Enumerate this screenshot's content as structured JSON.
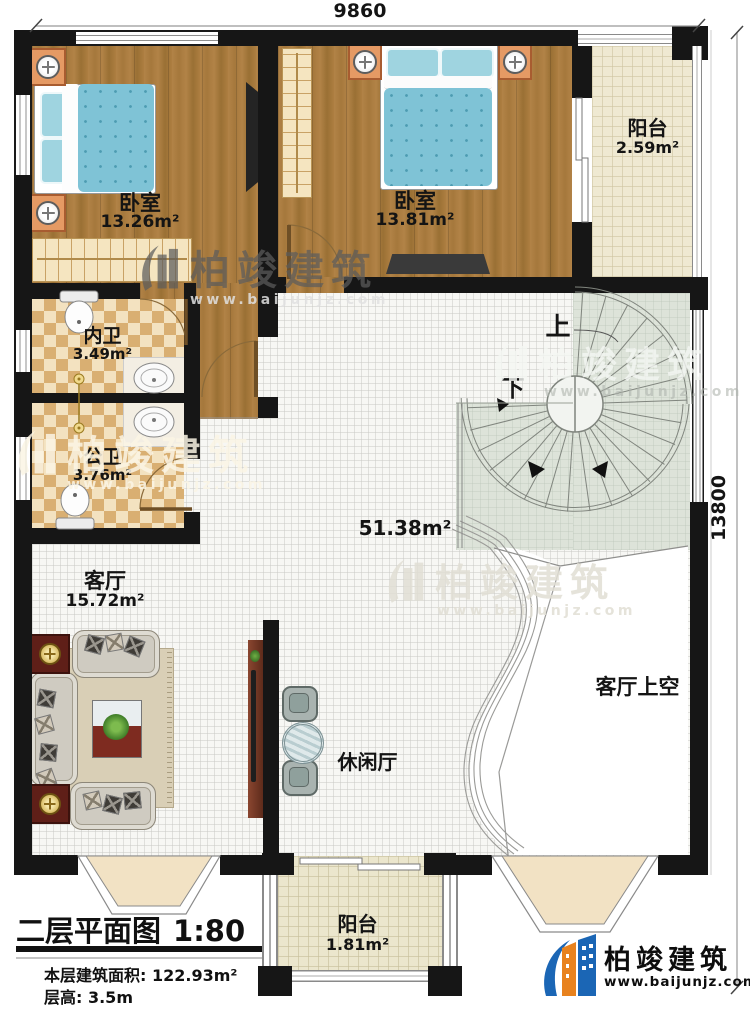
{
  "dimensions": {
    "top": "9860",
    "right": "13800"
  },
  "rooms": {
    "bedroom1": {
      "name": "卧室",
      "area": "13.26m²"
    },
    "bedroom2": {
      "name": "卧室",
      "area": "13.81m²"
    },
    "balcony_top": {
      "name": "阳台",
      "area": "2.59m²"
    },
    "inner_bath": {
      "name": "内卫",
      "area": "3.49m²"
    },
    "public_bath": {
      "name": "公卫",
      "area": "3.76m²"
    },
    "living_room": {
      "name": "客厅",
      "area": "15.72m²"
    },
    "hall": {
      "area": "51.38m²"
    },
    "leisure_hall": {
      "name": "休闲厅"
    },
    "living_void": {
      "name": "客厅上空"
    },
    "balcony_bottom": {
      "name": "阳台",
      "area": "1.81m²"
    }
  },
  "stair": {
    "up": "上",
    "down": "下"
  },
  "title_block": {
    "plan_title": "二层平面图",
    "scale": "1:80",
    "area_line": "本层建筑面积: 122.93m²",
    "height_line": "层高: 3.5m"
  },
  "brand": {
    "name": "柏竣建筑",
    "website": "www.baijunjz.com"
  },
  "watermark": {
    "name": "柏竣建筑",
    "website": "www.baijunjz.com"
  },
  "colors": {
    "wall": "#161616",
    "brand_blue": "#1b66b5",
    "brand_orange": "#e8821e"
  }
}
